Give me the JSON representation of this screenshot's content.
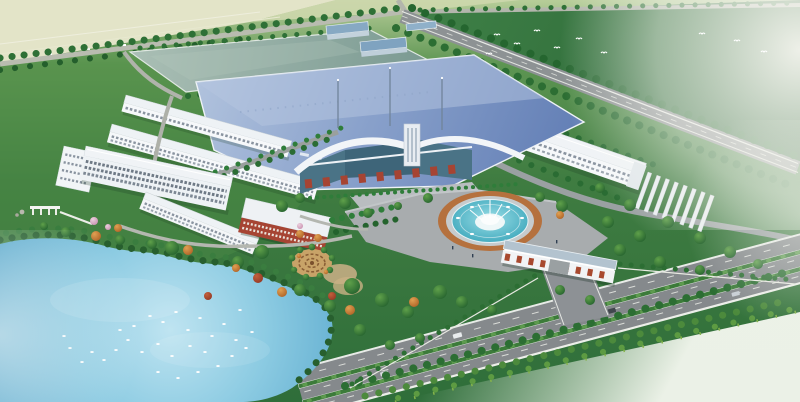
{
  "scene": {
    "description": "Aerial architectural rendering of an industrial factory campus: a large blue-roofed production hall with a glass-and-brick entrance hall and flag masts, long white warehouse and dormitory buildings, a white multi-storey office block, a rectangular grey-teal reservoir, a circular fountain plaza, a south gate with red brick piers, a landscaped lake with white waterfowl, a spiral parterre garden, rows of covered parking, and a tree-lined boulevard, all surrounded by green fields fading into haze.",
    "landmarks": {
      "fields": "open green fields fading into white haze",
      "farmland": "pale farmland strip at top left",
      "reservoir": "rectangular grey-teal water basin",
      "small_plants": "small blue-roofed utility buildings",
      "warehouse": "long white warehouse along the boundary road",
      "main_hall": "large blue metal-roof production hall",
      "dormitories": "two long white dormitory buildings",
      "offices": "white multi-storey office complex",
      "brick_building": "red brick building with white roof",
      "entrance_hall": "glass entrance hall with arched white canopies and masts",
      "fountain_plaza": "circular fountain plaza with tiered white fountain",
      "gate": "entrance gate with blue-grey roof and red brick piers",
      "lake": "landscaped lake with white waterfowl",
      "spiral_garden": "circular parterre garden with spiral paving",
      "carports": "rows of white covered parking",
      "boulevard": "tree-lined dual-carriageway boulevard",
      "boundary_road": "perimeter road with tree rows"
    },
    "counts": {
      "waterfowl_on_lake": 30,
      "flying_birds": 10,
      "carport_rows": 8,
      "flag_masts": 3,
      "boulevard_median_strips": 2
    }
  },
  "palette": {
    "lawn_green": "#4a8745",
    "deep_field_green": "#2c6b38",
    "pale_farmland": "#e3e4c8",
    "haze_white": "#f4f5ec",
    "roof_blue": "#8aa2cc",
    "roof_blue_light": "#b0c2dd",
    "roof_blue_dark": "#6380b6",
    "reservoir_teal": "#8fa89f",
    "building_white": "#f3f5f7",
    "window_gray": "#8a94a0",
    "brick_red": "#a64433",
    "road_gray": "#8d9294",
    "boulevard_gray": "#85898c",
    "median_green": "#3c7b3a",
    "tree_dark_green": "#1f5f2d",
    "tree_mid_green": "#2f7d3a",
    "autumn_orange": "#c4762e",
    "autumn_red": "#a8402e",
    "blossom_pink": "#d9aac4",
    "lake_blue": "#7fc4de",
    "fountain_teal": "#2f9fb5",
    "fountain_ring_brick": "#b5713e",
    "gate_roof_blue_gray": "#b3c3cf"
  }
}
